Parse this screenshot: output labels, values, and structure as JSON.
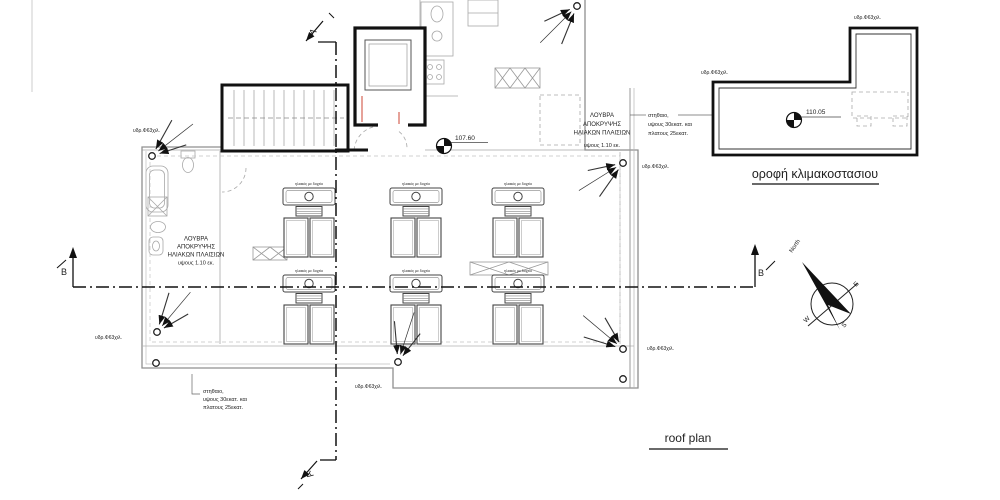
{
  "drawing": {
    "captions": {
      "main": "roof plan",
      "stair_roof": "οροφή κλιμακοστασιου"
    },
    "levels": {
      "main_roof": "107.60",
      "stair_roof": "110.05"
    },
    "notes": {
      "hydro": "υδρ.Φ63χιλ.",
      "parapet": [
        "στηθαιο,",
        "υψους 30εκατ. και",
        "πλατους 25εκατ."
      ],
      "louvre": [
        "ΛΟΥΒΡΑ",
        "ΑΠΟΚΡΥΨΗΣ",
        "ΗΛΙΑΚΩΝ ΠΛΑΙΣΙΩΝ"
      ],
      "louvre_height": "υψους 1.10 εκ.",
      "solar_unit": "ηλιακός με δοχείο"
    },
    "sections": {
      "a": "A",
      "b": "B"
    },
    "compass": {
      "north": "North",
      "east": "E",
      "west": "W",
      "south": "S"
    },
    "hydro_positions": [
      [
        133,
        132
      ],
      [
        95,
        339
      ],
      [
        355,
        388
      ],
      [
        647,
        350
      ],
      [
        642,
        168
      ],
      [
        701,
        74
      ],
      [
        854,
        19
      ]
    ],
    "solar_units": [
      [
        283,
        188
      ],
      [
        390,
        188
      ],
      [
        492,
        188
      ],
      [
        283,
        275
      ],
      [
        390,
        275
      ],
      [
        492,
        275
      ]
    ],
    "drains": [
      {
        "x": 152,
        "y": 156,
        "dir": 38
      },
      {
        "x": 157,
        "y": 332,
        "dir": 50
      },
      {
        "x": 398,
        "y": 362,
        "dir": 72
      },
      {
        "x": 577,
        "y": 6,
        "dir": 225
      },
      {
        "x": 623,
        "y": 163,
        "dir": 212
      },
      {
        "x": 623,
        "y": 349,
        "dir": 140
      },
      {
        "x": 725,
        "y": 94,
        "dir": 322
      },
      {
        "x": 861,
        "y": 41,
        "dir": 305
      }
    ],
    "outlets": [
      [
        156,
        363
      ],
      [
        623,
        379
      ]
    ]
  }
}
